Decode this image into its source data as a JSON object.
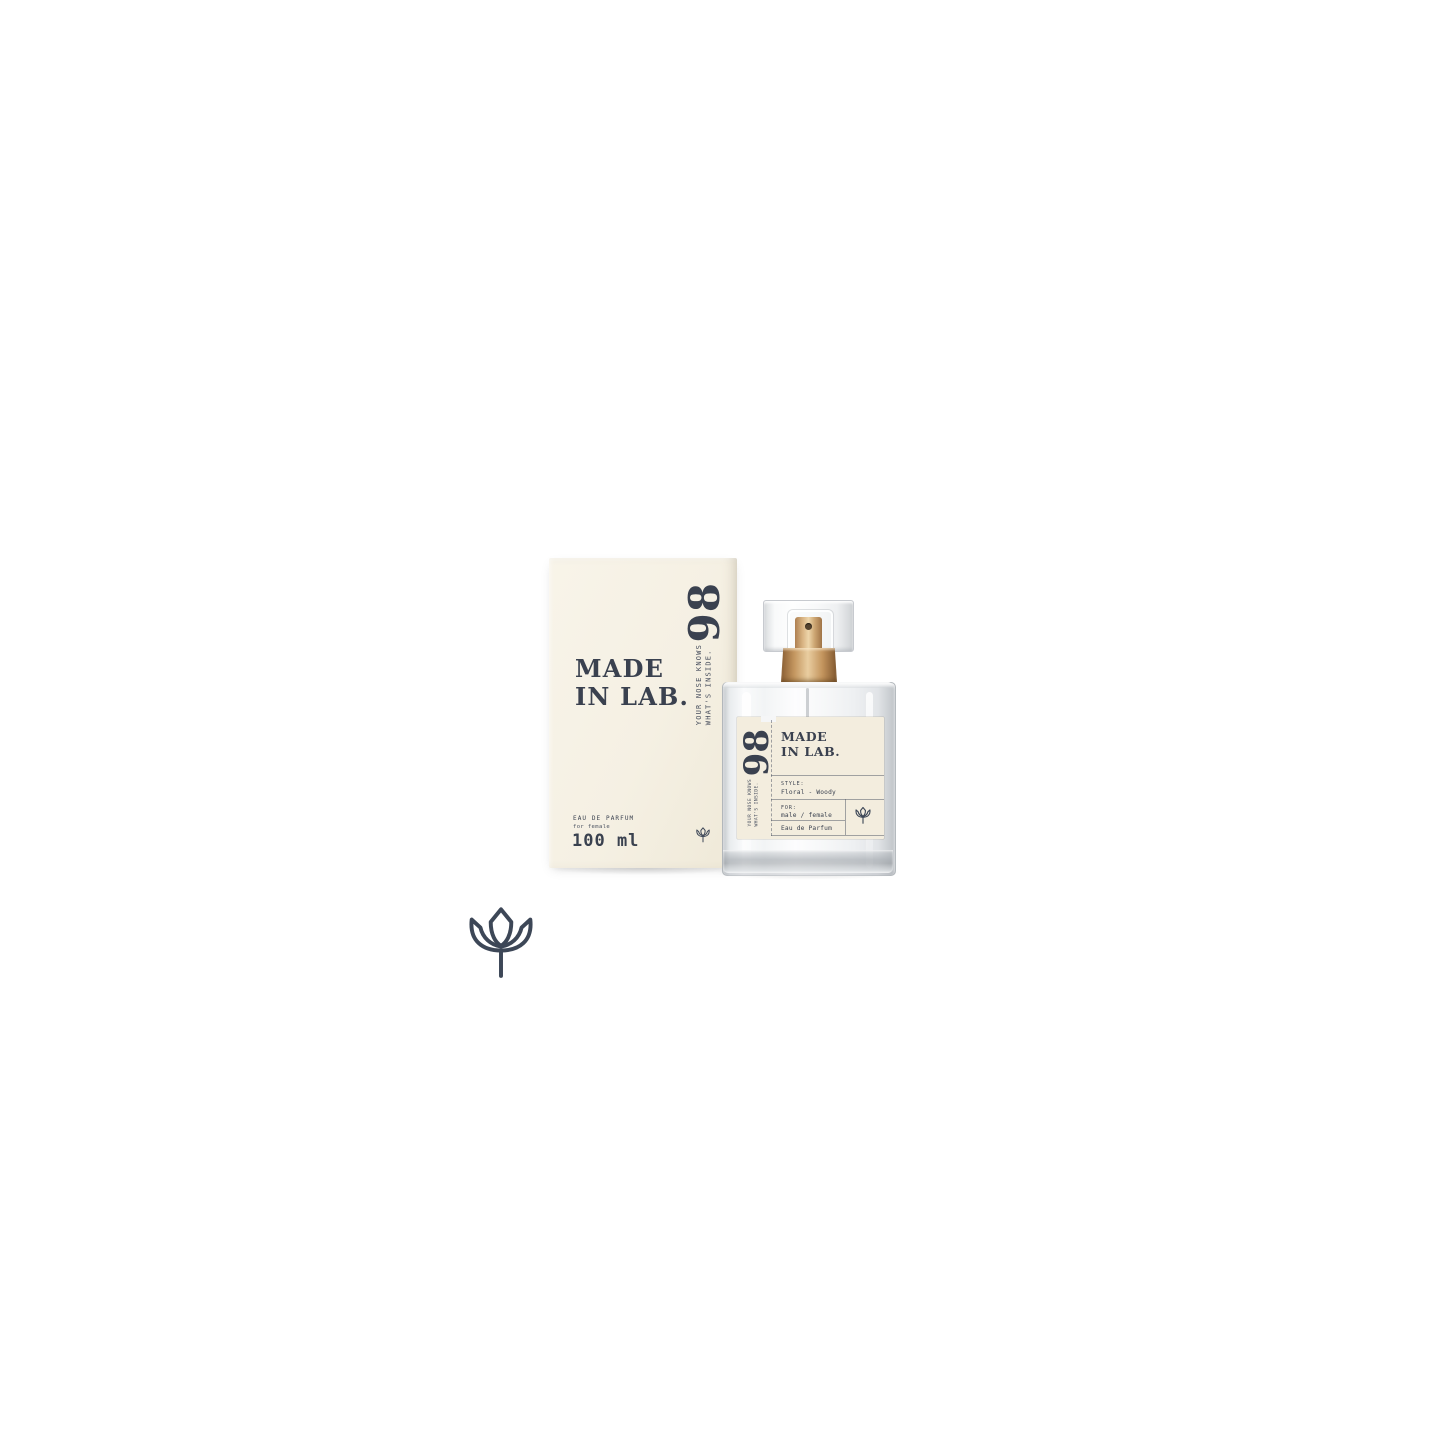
{
  "product_photo": {
    "variant_number": "98",
    "brand": {
      "line1": "MADE",
      "line2": "IN LAB."
    },
    "tagline": {
      "line1": "YOUR NOSE KNOWS",
      "line2": "WHAT'S INSIDE."
    },
    "box": {
      "type": "EAU DE PARFUM",
      "audience": "for female",
      "volume": "100 ml"
    },
    "bottle_label": {
      "style_label": "STYLE:",
      "style_value": "Floral - Woody",
      "for_label": "FOR:",
      "for_value": "male / female",
      "type": "Eau de Parfum"
    },
    "icons": {
      "tulip": "tulip-flower"
    },
    "colors": {
      "background": "#ffffff",
      "box_cream": "#f5f0e3",
      "label_cream": "#f3edde",
      "text_navy": "#3a414f",
      "sprayer_gold": "#c49760",
      "glass_gray": "#c5c9cc"
    }
  }
}
